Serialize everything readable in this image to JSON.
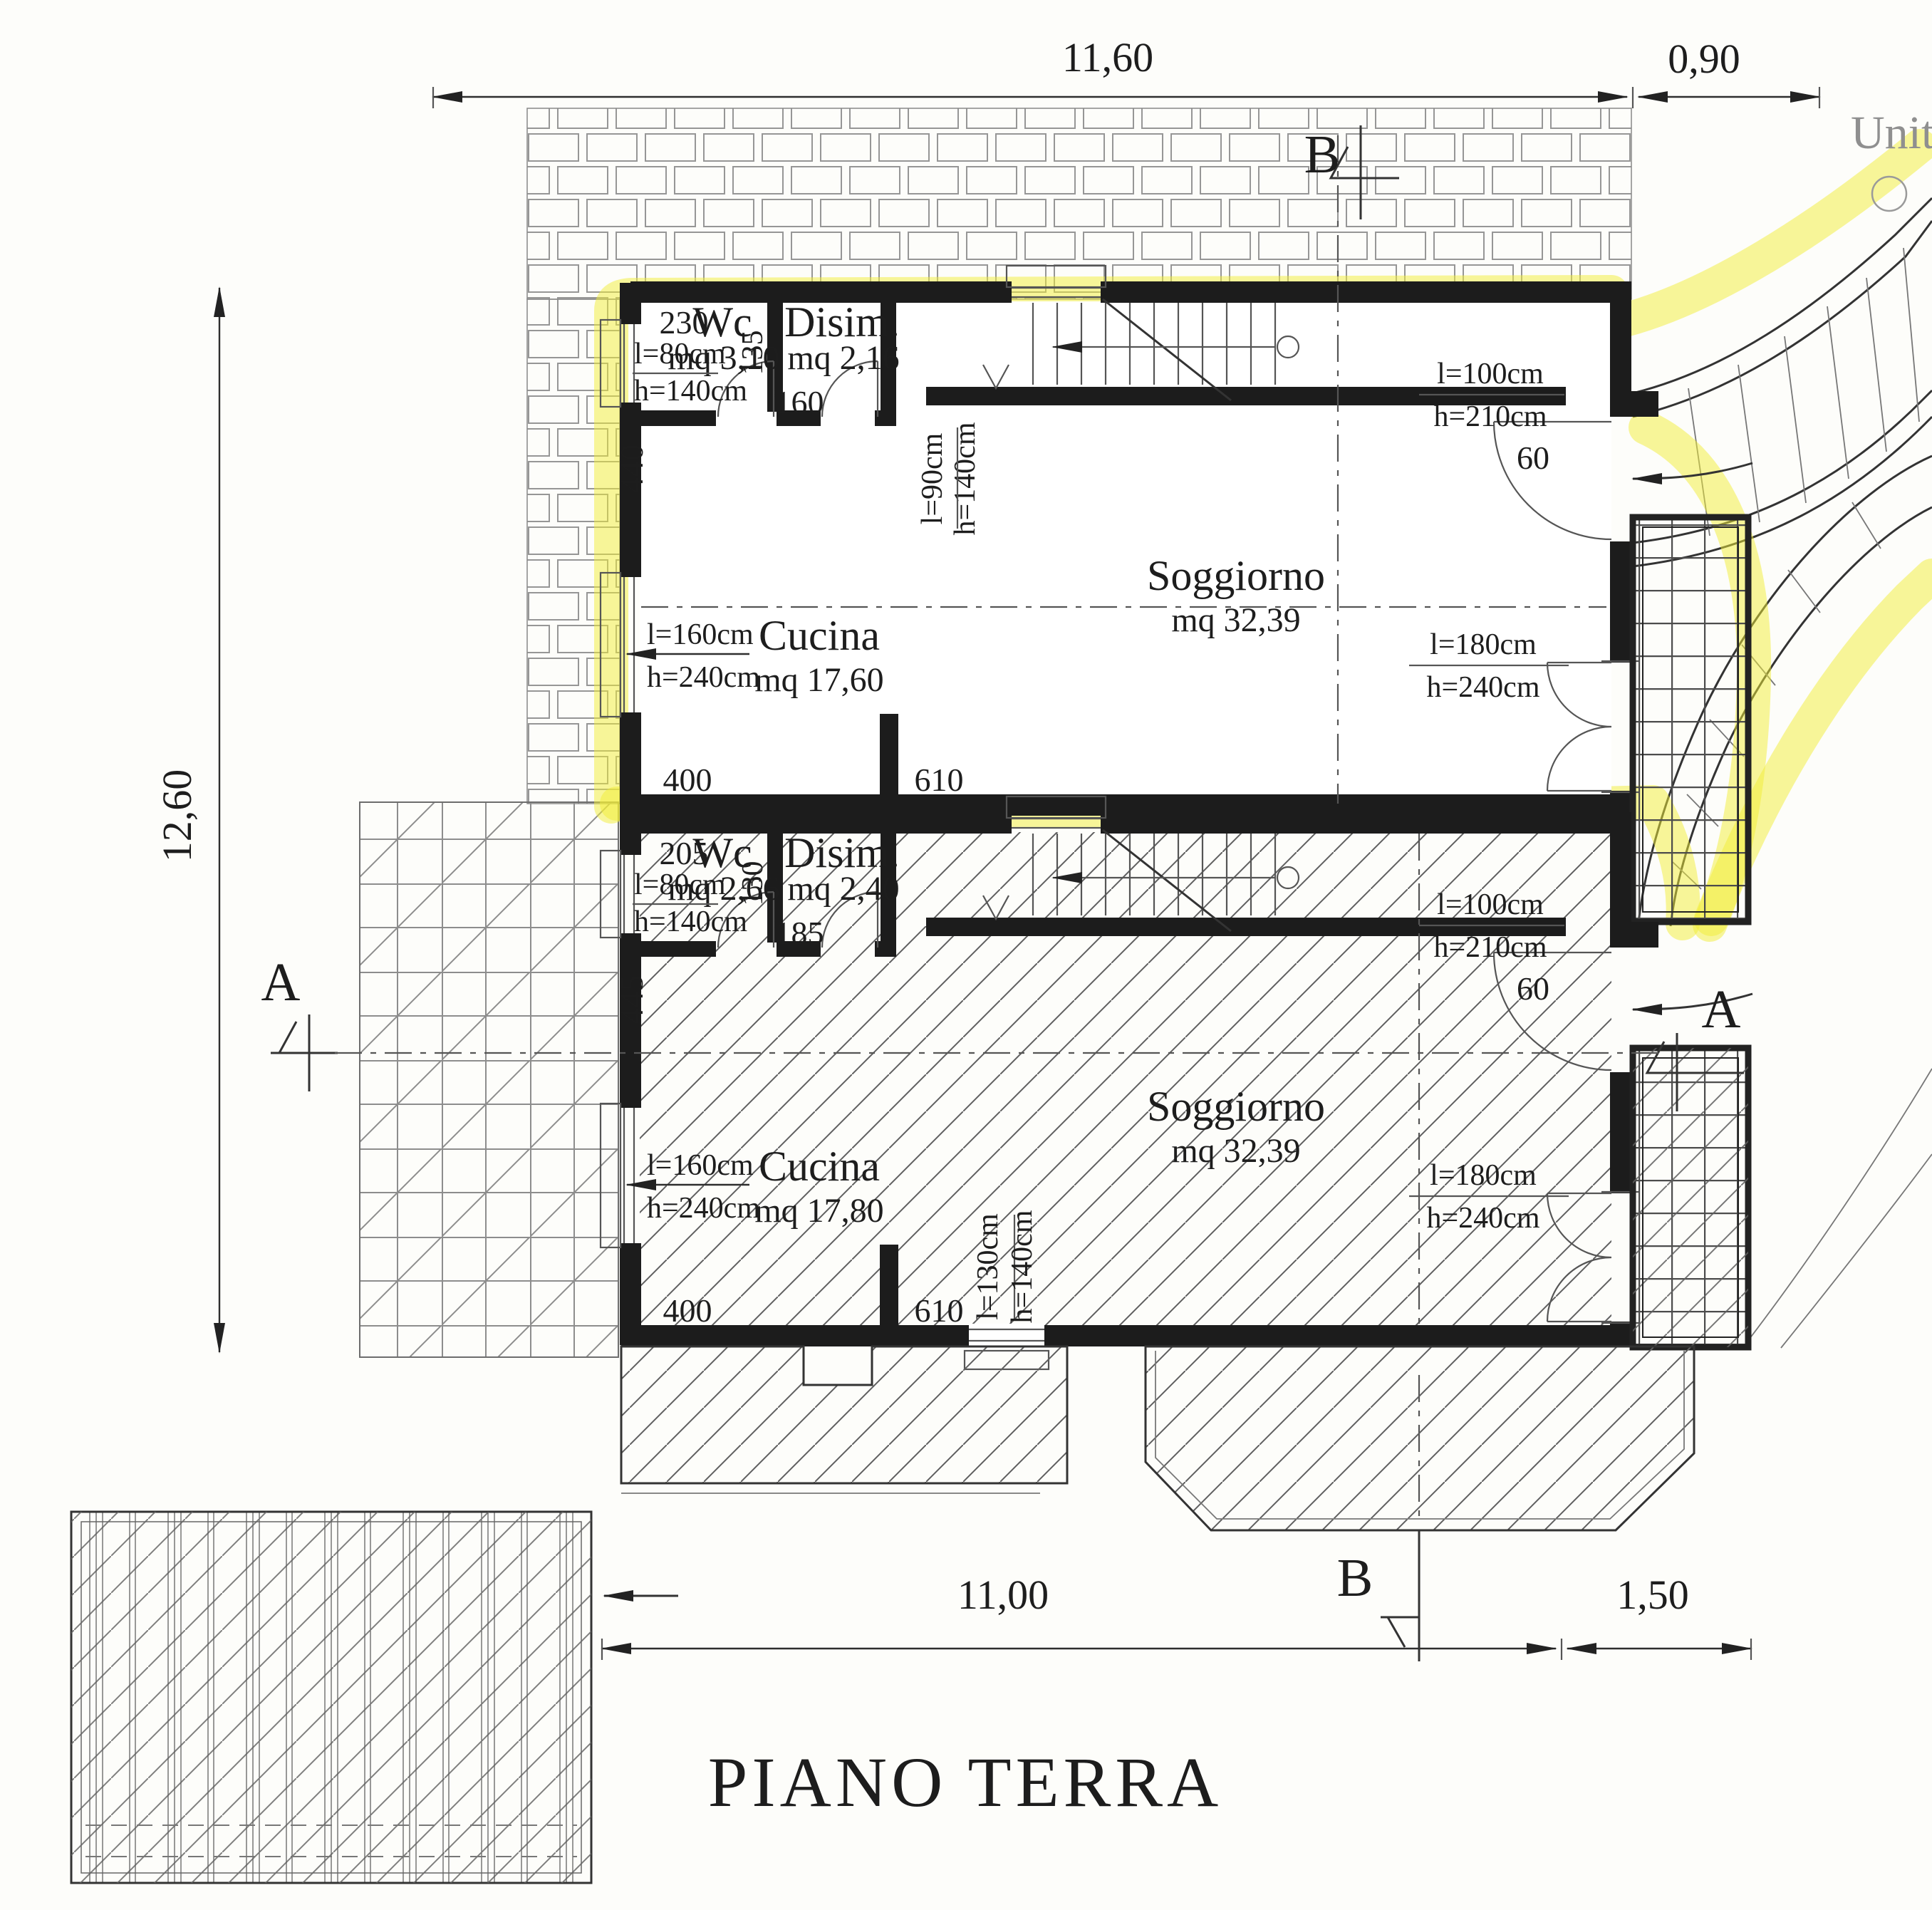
{
  "title": "PIANO TERRA",
  "site_label": "Unit",
  "section_markers": {
    "a": "A",
    "b": "B"
  },
  "overall_dims": {
    "top_main": "11,60",
    "top_right": "0,90",
    "left": "12,60",
    "bottom_main": "11,00",
    "bottom_right": "1,50"
  },
  "upper_plan": {
    "rooms": {
      "wc": {
        "name": "Wc",
        "area": "mq 3,10"
      },
      "disim": {
        "name": "Disim.",
        "area": "mq 2,16"
      },
      "cucina": {
        "name": "Cucina",
        "area": "mq 17,60"
      },
      "soggiorno": {
        "name": "Soggiorno",
        "area": "mq 32,39"
      }
    },
    "openings": {
      "wc_window": {
        "w": "l=80cm",
        "h": "h=140cm"
      },
      "stair_window": {
        "w": "l=90cm",
        "h": "h=140cm"
      },
      "entry_door": {
        "w": "l=100cm",
        "h": "h=210cm"
      },
      "cucina_window": {
        "w": "l=160cm",
        "h": "h=240cm"
      },
      "soggiorno_door": {
        "w": "l=180cm",
        "h": "h=240cm"
      }
    },
    "dims": {
      "wc_width": "230",
      "wc_depth": "135",
      "wc_door": "160",
      "left_wall": "440",
      "cucina_width": "400",
      "soggiorno_width": "610",
      "entry_jamb": "60"
    }
  },
  "lower_plan": {
    "rooms": {
      "wc": {
        "name": "Wc",
        "area": "mq 2,66"
      },
      "disim": {
        "name": "Disim.",
        "area": "mq 2,40"
      },
      "cucina": {
        "name": "Cucina",
        "area": "mq 17,80"
      },
      "soggiorno": {
        "name": "Soggiorno",
        "area": "mq 32,39"
      }
    },
    "openings": {
      "wc_window": {
        "w": "l=80cm",
        "h": "h=140cm"
      },
      "entry_door": {
        "w": "l=100cm",
        "h": "h=210cm"
      },
      "cucina_window": {
        "w": "l=160cm",
        "h": "h=240cm"
      },
      "soggiorno_door": {
        "w": "l=180cm",
        "h": "h=240cm"
      },
      "soggiorno_window": {
        "w": "l=130cm",
        "h": "h=140cm"
      }
    },
    "dims": {
      "wc_width": "205",
      "wc_depth": "130",
      "wc_door": "185",
      "left_wall": "445",
      "cucina_width": "400",
      "soggiorno_width": "610",
      "entry_jamb": "60"
    }
  }
}
